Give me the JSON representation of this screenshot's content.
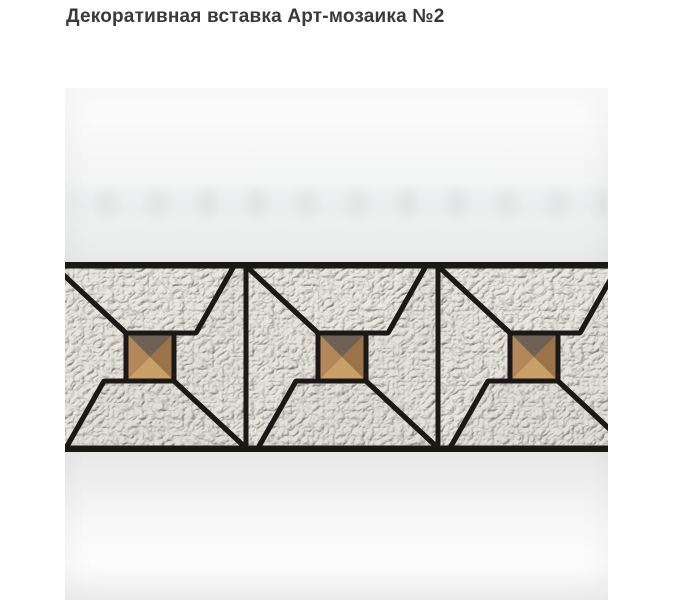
{
  "page": {
    "title": "Декоративная вставка Арт-мозаика №2",
    "background": "#ffffff",
    "title_color": "#3a3a3a"
  },
  "photo": {
    "background_top": "#fdfdfd",
    "background_mid": "#e7e8e8",
    "background_bottom": "#f0f0f0"
  },
  "mosaic": {
    "description": "бордюр из трёх модулей-вертушек с янтарными стеклянными вставками",
    "module_count": 3,
    "grout_color": "#1b1916",
    "band": {
      "top": 174,
      "height": 190,
      "border": 4,
      "width": 543
    },
    "module_width": 192,
    "inner_height": 182,
    "module_offsets": [
      -11,
      181,
      373
    ],
    "grout_width": 5,
    "tile_fills": [
      "#e8e5de",
      "#eae7e0",
      "#e5e3dc",
      "#e2e0da"
    ],
    "pieces": [
      {
        "name": "left-dart-tile",
        "points": "0,0 72,67 72,115 50,115 12,182 0,182",
        "fill": 0
      },
      {
        "name": "top-tile",
        "points": "0,0 180,0 142,67 120,67 72,67",
        "fill": 1
      },
      {
        "name": "right-dart-tile",
        "points": "180,0 192,0 192,182 120,115 120,67 142,67",
        "fill": 2
      },
      {
        "name": "bottom-tile",
        "points": "12,182 50,115 72,115 120,115 192,182",
        "fill": 3
      }
    ],
    "glass": {
      "name": "amber-glass-square",
      "rect": [
        72,
        67,
        48,
        48
      ],
      "base_gradient": [
        "#8d6a45",
        "#c79c66"
      ],
      "facets": [
        {
          "name": "facet-top",
          "points": "72,67 120,67 96,91",
          "fill": "#6f6254"
        },
        {
          "name": "facet-right",
          "points": "120,67 120,115 96,91",
          "fill": "#9c744a"
        },
        {
          "name": "facet-bottom",
          "points": "72,115 120,115 96,91",
          "fill": "#c9a065"
        },
        {
          "name": "facet-left",
          "points": "72,67 72,115 96,91",
          "fill": "#b2885a"
        }
      ]
    }
  }
}
